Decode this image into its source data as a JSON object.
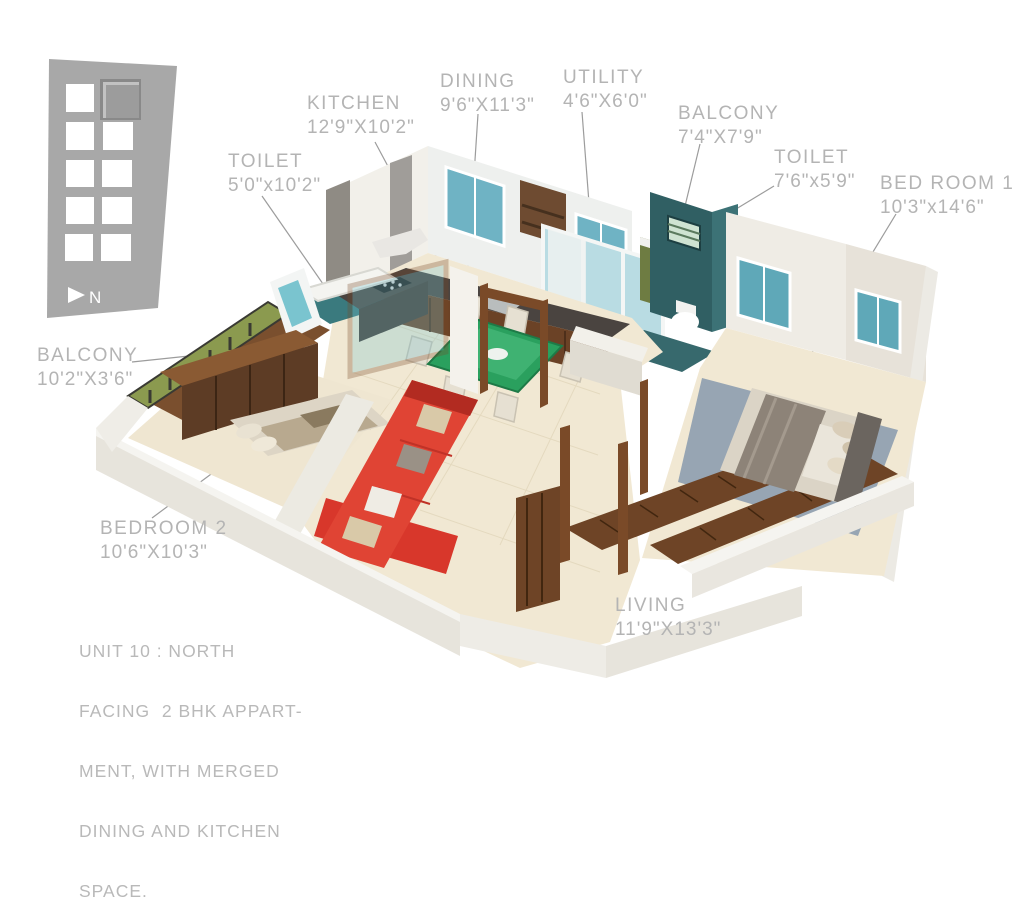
{
  "page": {
    "type": "3d-floor-plan-rendering",
    "background": "#ffffff"
  },
  "key_plan": {
    "grid_rows": 5,
    "grid_cols": 2,
    "highlighted_unit": "top-right",
    "north_label": "N"
  },
  "rooms": {
    "kitchen": {
      "name": "KITCHEN",
      "dims": "12'9\"X10'2\""
    },
    "toilet_1": {
      "name": "TOILET",
      "dims": "5'0\"x10'2\""
    },
    "dining": {
      "name": "DINING",
      "dims": "9'6\"X11'3\""
    },
    "utility": {
      "name": "UTILITY",
      "dims": "4'6\"X6'0\""
    },
    "balcony_2": {
      "name": "BALCONY",
      "dims": "7'4\"X7'9\""
    },
    "toilet_2": {
      "name": "TOILET",
      "dims": "7'6\"x5'9\""
    },
    "bed_room_1": {
      "name": "BED ROOM 1",
      "dims": "10'3\"x14'6\""
    },
    "balcony_1": {
      "name": "BALCONY",
      "dims": "10'2\"X3'6\""
    },
    "bedroom_2": {
      "name": "BEDROOM 2",
      "dims": "10'6\"X10'3\""
    },
    "living": {
      "name": "LIVING",
      "dims": "11'9\"X13'3\""
    }
  },
  "caption": {
    "lines": [
      "UNIT 10 : NORTH",
      "FACING  2 BHK APPART-",
      "MENT, WITH MERGED",
      "DINING AND KITCHEN",
      "SPACE."
    ]
  },
  "colors": {
    "label_gray": "#b4b4b4",
    "keyplan_gray": "#a8a8a8",
    "floor_cream": "#f1e8d3",
    "wall_white": "#f2f0ea",
    "wood_brown": "#6e4426",
    "sofa_red": "#dd3a2e",
    "window_teal": "#6fb3c4",
    "mosaic_teal": "#305f63",
    "balcony_green": "#8b9a4f",
    "table_green": "#2aa05e",
    "rug_blue": "#97a5b3",
    "granite_dark": "#4a4440"
  }
}
